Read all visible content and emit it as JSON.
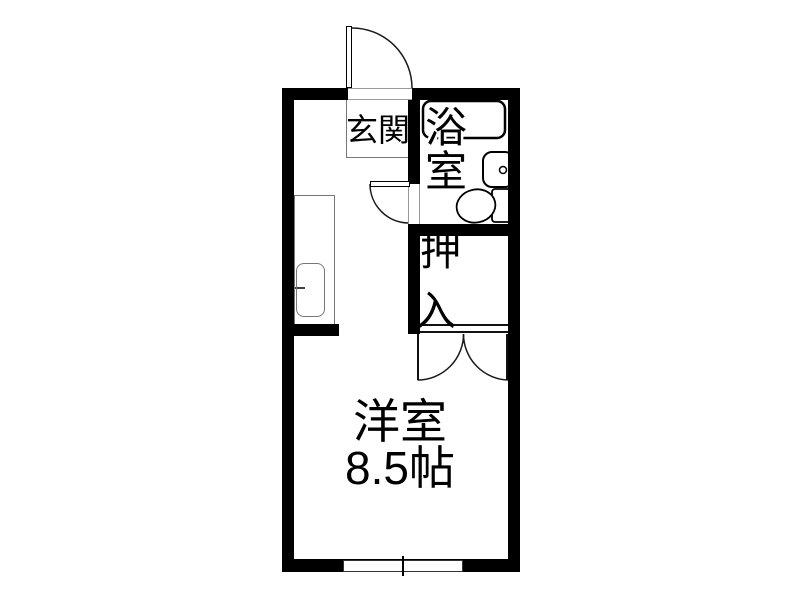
{
  "floorplan": {
    "labels": {
      "genkan": "玄関",
      "bathroom": "浴室",
      "closet": "押入",
      "main_room_name": "洋室",
      "main_room_size": "8.5帖"
    },
    "fixtures": [
      "entrance-door",
      "bathroom-door",
      "closet-double-doors",
      "bathtub",
      "wash-basin",
      "toilet",
      "kitchen-counter",
      "kitchen-sink",
      "sliding-window"
    ],
    "colors": {
      "wall": "#000000",
      "line": "#1a1a1a",
      "frame": "#777777",
      "background": "#ffffff"
    }
  }
}
